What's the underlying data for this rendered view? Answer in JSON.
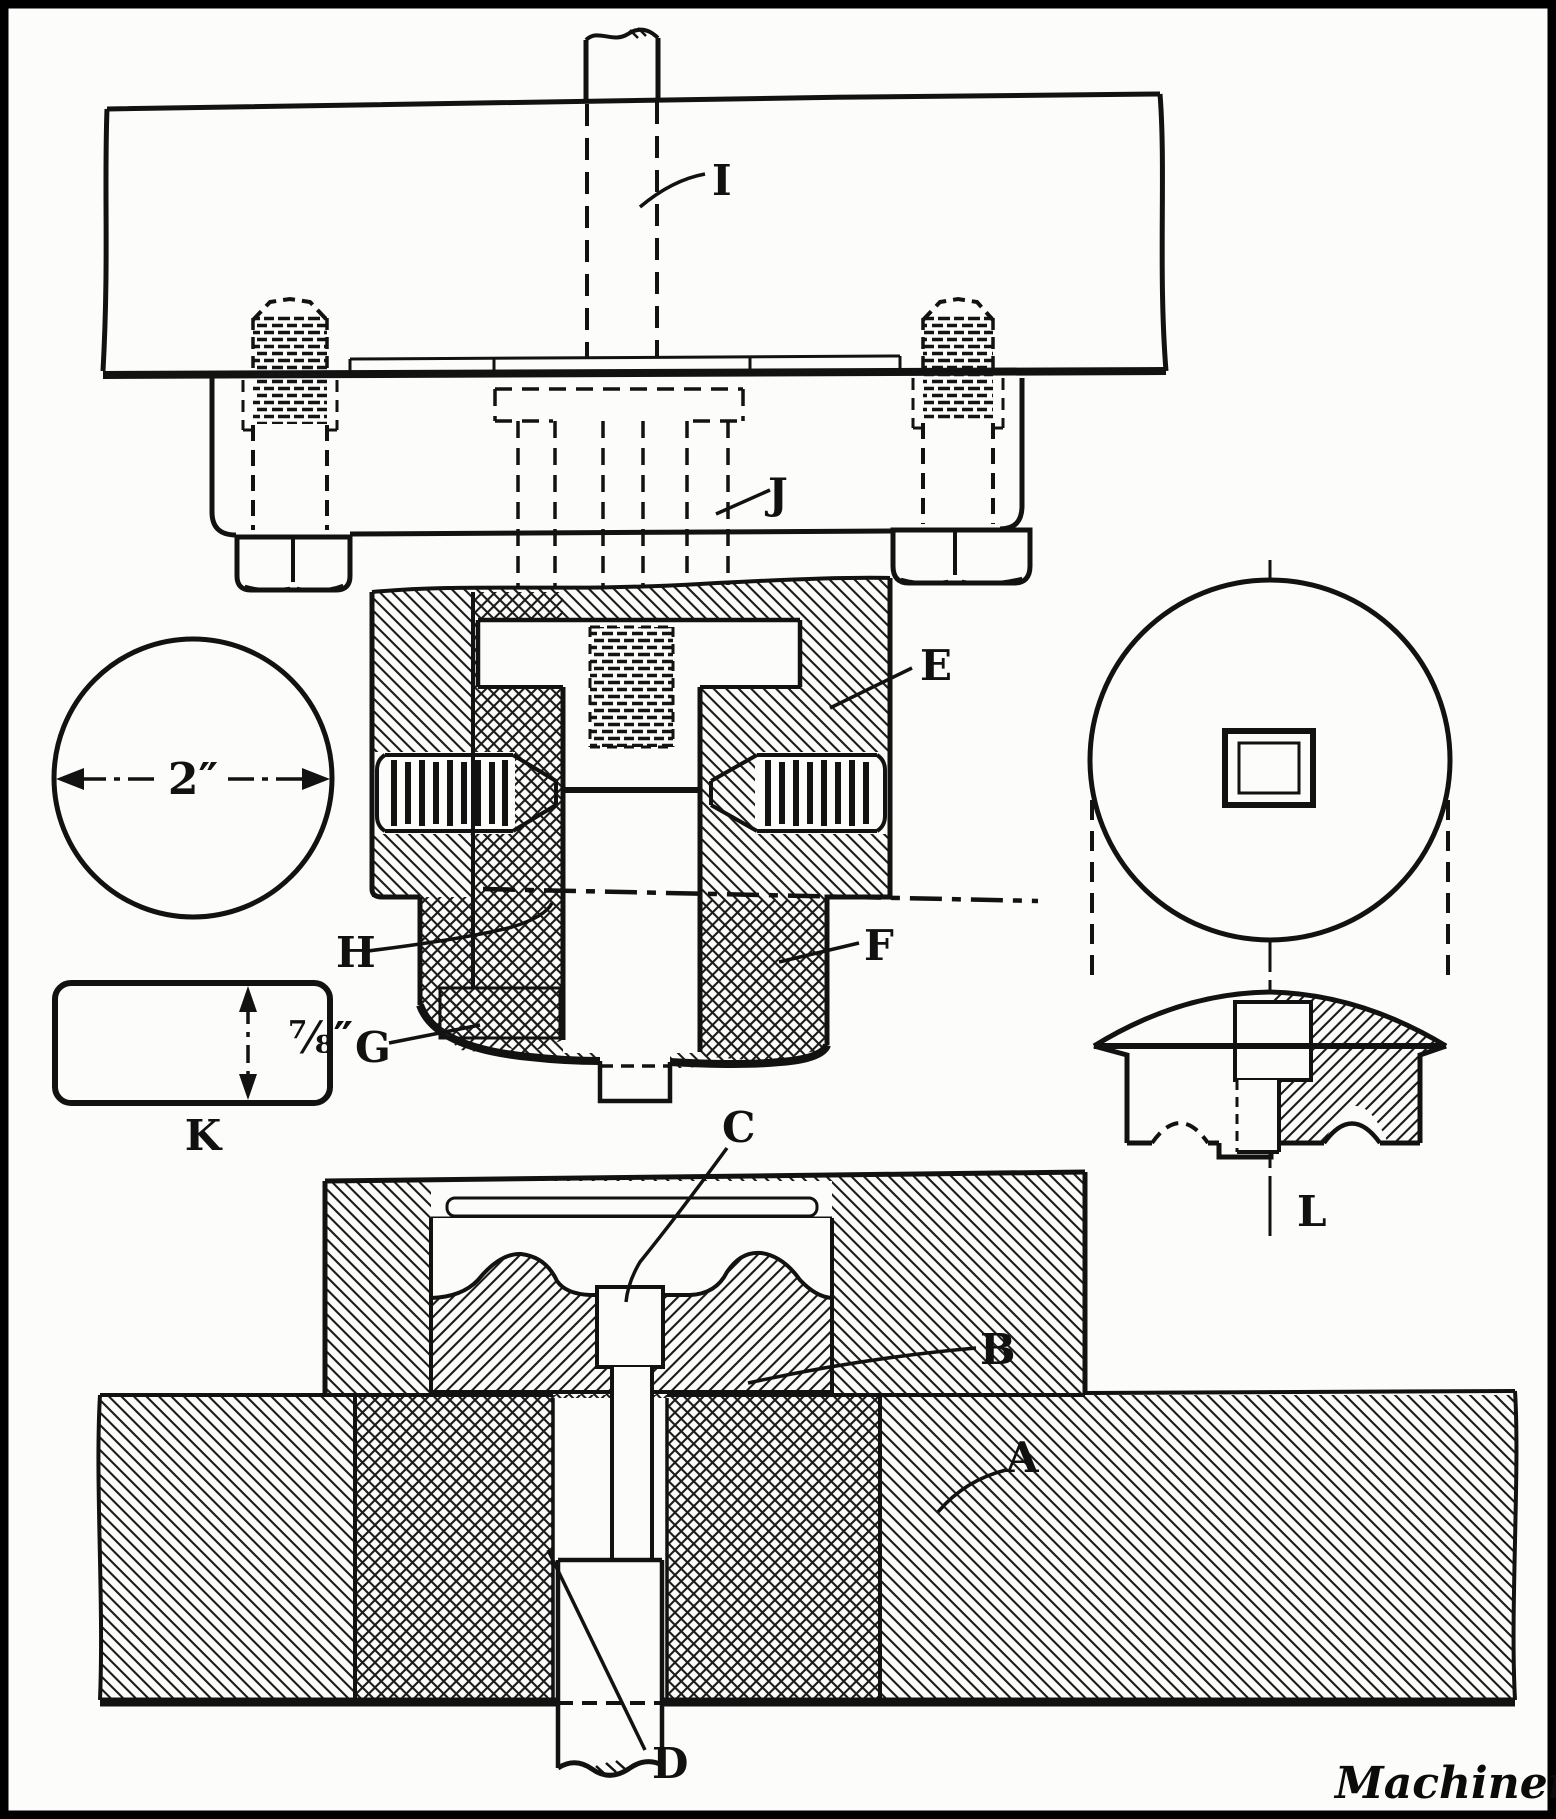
{
  "diagram": {
    "logo": "Machinery",
    "labels": {
      "I": "I",
      "J": "J",
      "E": "E",
      "F": "F",
      "H": "H",
      "G": "G",
      "K": "K",
      "L": "L",
      "A": "A",
      "B": "B",
      "C": "C",
      "D": "D"
    },
    "dimensions": {
      "blank_diameter": "2″",
      "blank_thickness": "⅞″"
    }
  }
}
